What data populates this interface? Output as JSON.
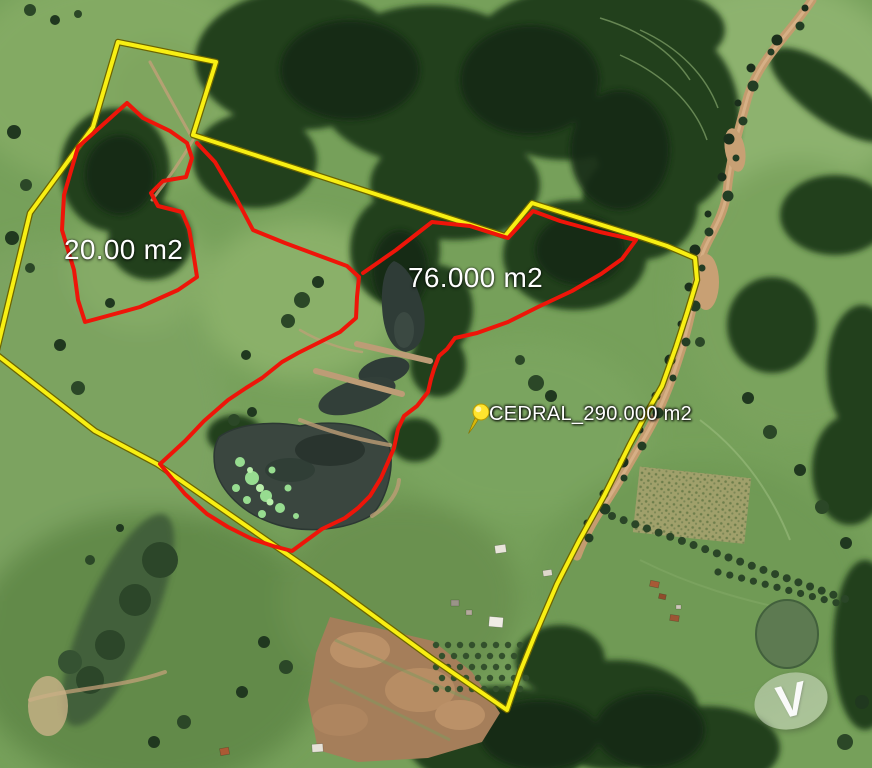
{
  "map": {
    "description": "aerial satellite view of rural property with boundary overlays",
    "parcels": {
      "small": {
        "label": "20.00 m2",
        "boundary_color": "#ee1509"
      },
      "medium": {
        "label": "76.000 m2",
        "boundary_color": "#ee1509"
      },
      "property": {
        "label": "CEDRAL_290.000 m2",
        "boundary_color": "#f8ef13",
        "pin_color": "#ffe42e"
      }
    },
    "watermark": {
      "letter": "V"
    },
    "colors": {
      "boundary_yellow": "#f8ef13",
      "boundary_red": "#ee1509",
      "label_text": "#ffffff",
      "road_dirt": "#c49c6f",
      "water": "#3a463f",
      "algae": "#97dc90"
    }
  }
}
